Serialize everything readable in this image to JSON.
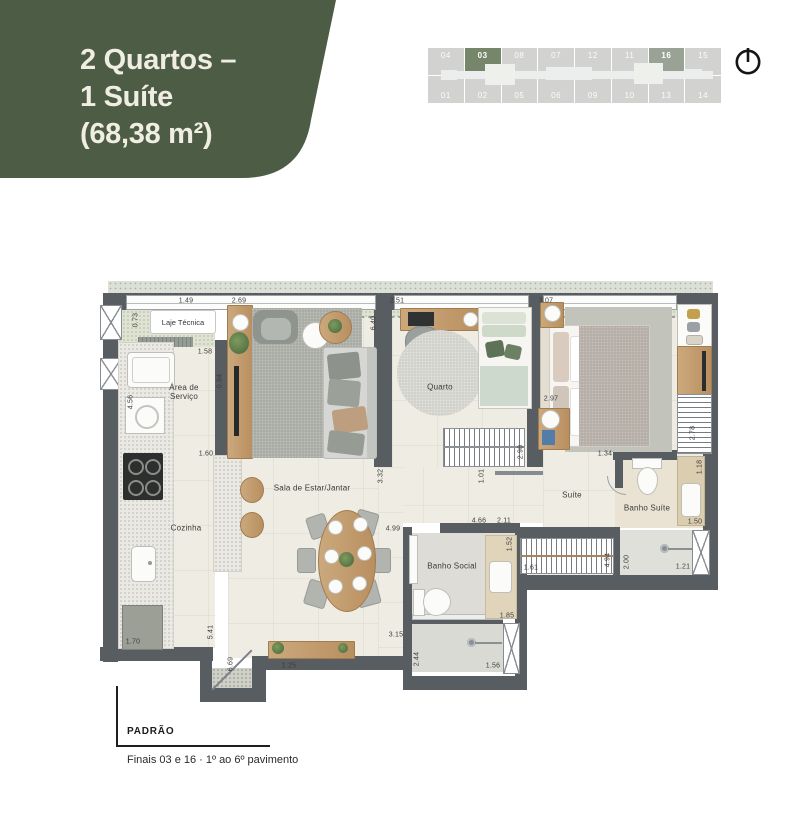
{
  "colors": {
    "badge_green": "#4d5c45",
    "badge_text": "#f0ede2",
    "unit_highlight_primary": "#76866a",
    "unit_highlight_secondary": "#99a295",
    "keyplan_cell": "#d2d3d0",
    "wall": "#585d62",
    "floor": "#efece3"
  },
  "header": {
    "title_line1": "2 Quartos –",
    "title_line2": "1 Suíte",
    "title_line3": "(68,38 m²)"
  },
  "keyplan": {
    "top": [
      "04",
      "03",
      "08",
      "07",
      "12",
      "11",
      "16",
      "15"
    ],
    "bottom": [
      "01",
      "02",
      "05",
      "06",
      "09",
      "10",
      "13",
      "14"
    ],
    "highlighted_units": [
      "03",
      "16"
    ]
  },
  "plan": {
    "rooms": {
      "laje": "Laje Técnica",
      "servico": "Área de Serviço",
      "cozinha": "Cozinha",
      "sala": "Sala de Estar/Jantar",
      "quarto": "Quarto",
      "suite": "Suíte",
      "banho_suite": "Banho Suíte",
      "banho_social": "Banho Social"
    },
    "dims": [
      "1.49",
      "2.69",
      "0.73",
      "1.58",
      "0.84",
      "4.56",
      "1.60",
      "1.70",
      "5.41",
      "6.69",
      "1.25",
      "3.15",
      "6.40",
      "2.51",
      "3.32",
      "2.98",
      "1.01",
      "4.99",
      "3.07",
      "2.97",
      "1.34",
      "2.78",
      "1.18",
      "1.50",
      "2.00",
      "1.21",
      "4.66",
      "2.11",
      "1.52",
      "1.85",
      "2.44",
      "1.56",
      "1.61",
      "4.94"
    ]
  },
  "footer": {
    "type_label": "PADRÃO",
    "note": "Finais 03 e 16  ·  1º ao 6º pavimento"
  }
}
